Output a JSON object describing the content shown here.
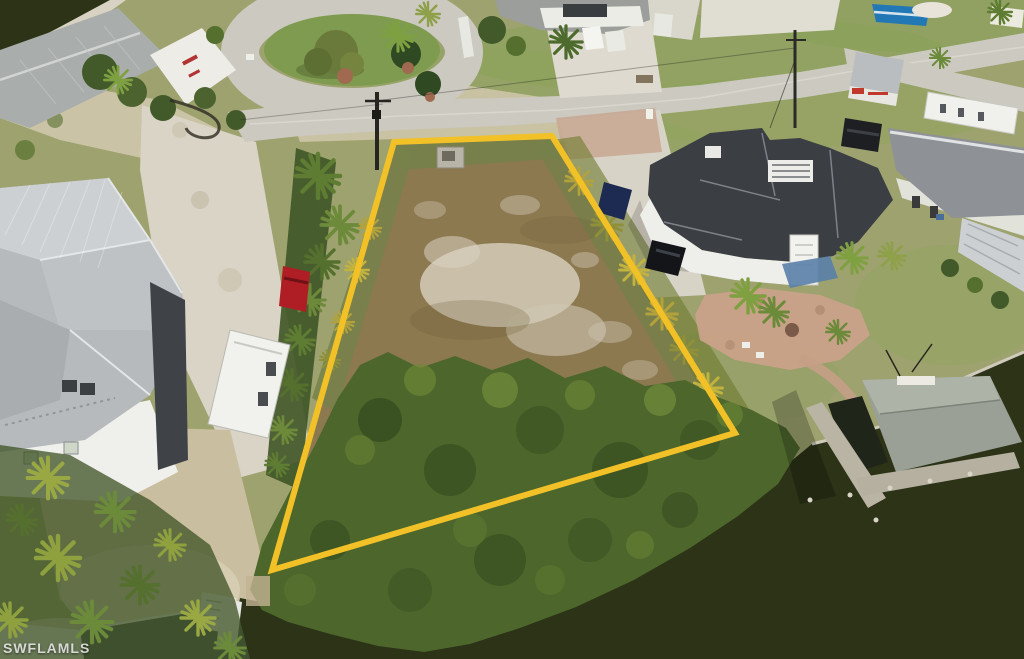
{
  "watermark": {
    "text": "SWFLAMLS"
  },
  "annotation": {
    "lot_outline_points": "394,142 552,136 735,433 272,570",
    "lot_outline_color": "#F2C127",
    "lot_outline_width": "6"
  },
  "palette": {
    "grass": "#9DA26E",
    "grass_bright": "#84A055",
    "road": "#CBC9C0",
    "dirt_lot": "#8C7950",
    "sand": "#D5CCB2",
    "gravel": "#D9D4C6",
    "vegetation": "#4C662C",
    "water": "#2C3317",
    "roof_silver": "#B6BABD",
    "roof_charcoal": "#3B3E43",
    "roof_gray": "#8E9296",
    "dock_roof": "#9AA095",
    "paver_patio": "#C9A289",
    "red_suv": "#AF1E25",
    "shed_red": "#C0392B",
    "boat_blue": "#2277B5"
  }
}
